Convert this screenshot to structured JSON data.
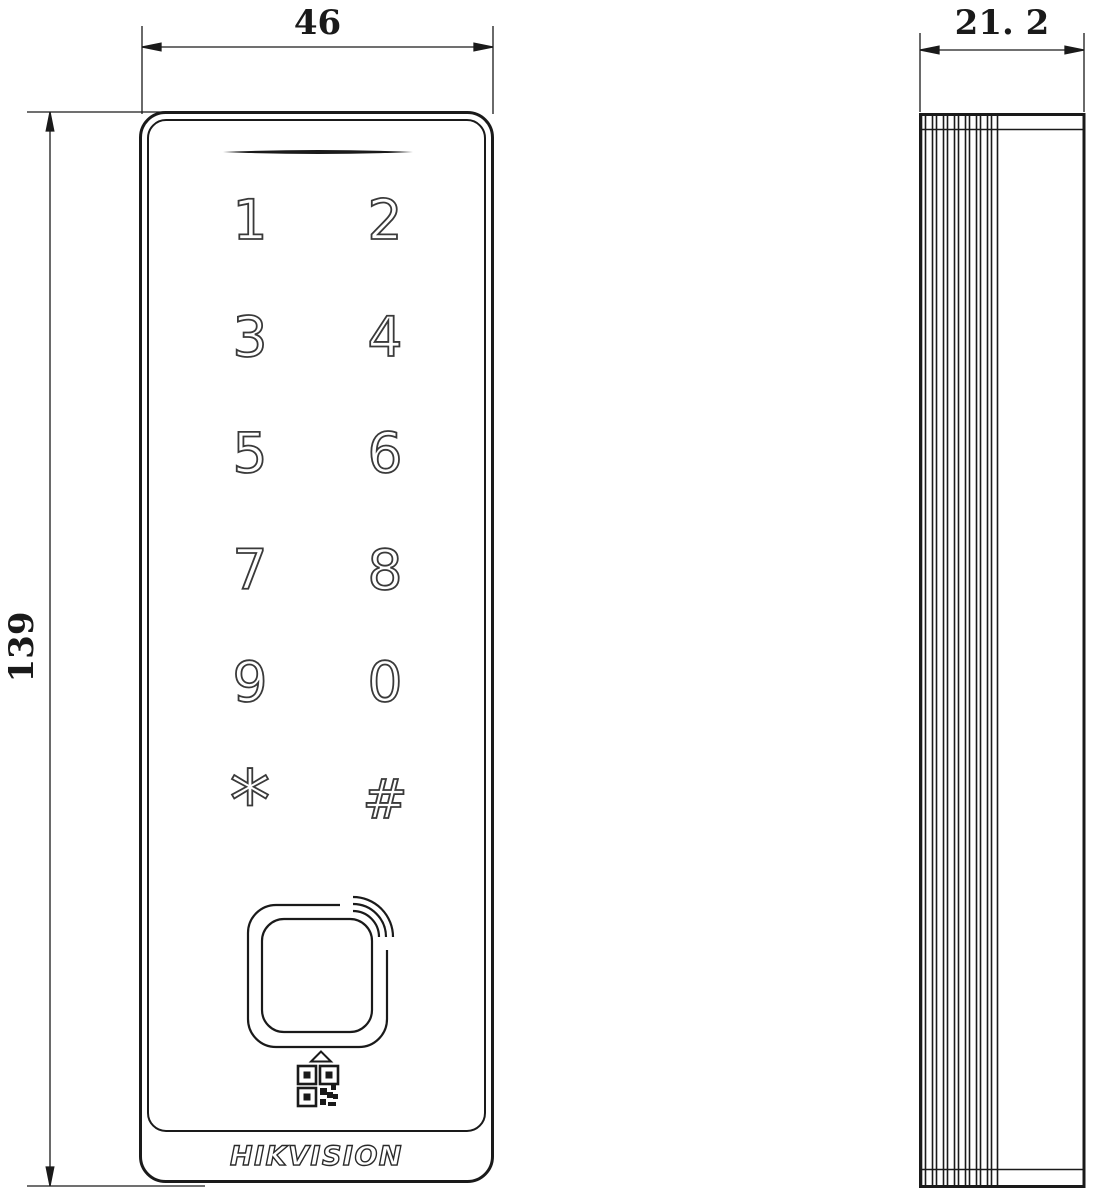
{
  "drawing": {
    "type": "technical-dimension-drawing",
    "views": {
      "left": "front-view",
      "right": "side-view"
    },
    "dimensions": {
      "width_label": "46",
      "height_label": "139",
      "depth_label": "21. 2"
    },
    "front_view": {
      "keypad_keys": [
        "1",
        "2",
        "3",
        "4",
        "5",
        "6",
        "7",
        "8",
        "9",
        "0",
        "*",
        "#"
      ],
      "brand_logo": "HIKVISION",
      "icons": {
        "speaker": "speaker-slot-icon",
        "card_reader": "contactless-card-reader-icon",
        "arrow": "up-arrow-icon",
        "qr": "qr-code-icon"
      }
    },
    "side_view": {
      "texture": "ribbed-left-edge"
    },
    "colors": {
      "line": "#1a1a1a",
      "background": "#ffffff"
    }
  }
}
